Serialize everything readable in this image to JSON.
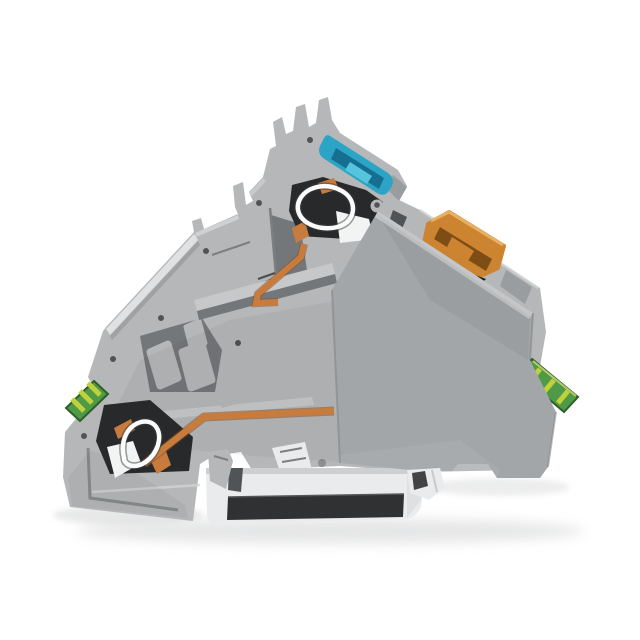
{
  "image": {
    "kind": "product-photo",
    "subject": "cutaway-din-rail-terminal-block",
    "background": "#ffffff"
  },
  "colors": {
    "body": "#b5b7b9",
    "body_light": "#c6c8c9",
    "plate": "#a3a6a8",
    "plate_light": "#c4c6c8",
    "cavity": "#27292b",
    "blue": "#2ba4c6",
    "blue_dark": "#166f90",
    "blue_light": "#55c4dd",
    "orange": "#cd8430",
    "orange_dark": "#7e4d15",
    "orange_light": "#e7b064",
    "copper": "#c77c3e",
    "copper_dark": "#8a4e20",
    "spring": "#fbfbfb",
    "white_part": "#f2f3f3",
    "green": "#4e9a46",
    "green_dark": "#2e5e2b",
    "yellow": "#c0d13c",
    "metal": "#eaebec",
    "metal_mid": "#c8cacb",
    "metal_dark": "#2f3133",
    "shadow": "#d2d3d4",
    "ink": "#1b1c1d"
  },
  "parts": {
    "body": "terminal-block-body",
    "upper_deck": "upper-terminal-deck",
    "end_plate": "gray-end-plate",
    "din_rail": "din-mounting-rail",
    "rail_clip": "rail-clip-foot",
    "mounting_foot": "mounting-foot",
    "blue_lever": "blue-push-button",
    "orange_lever": "orange-push-button",
    "spring_upper": "upper-cage-spring",
    "spring_lower": "lower-cage-spring",
    "busbar_upper": "upper-copper-busbar",
    "busbar_lower": "lower-copper-busbar",
    "ground_left": "ground-marker-left",
    "ground_right": "ground-marker-right"
  }
}
